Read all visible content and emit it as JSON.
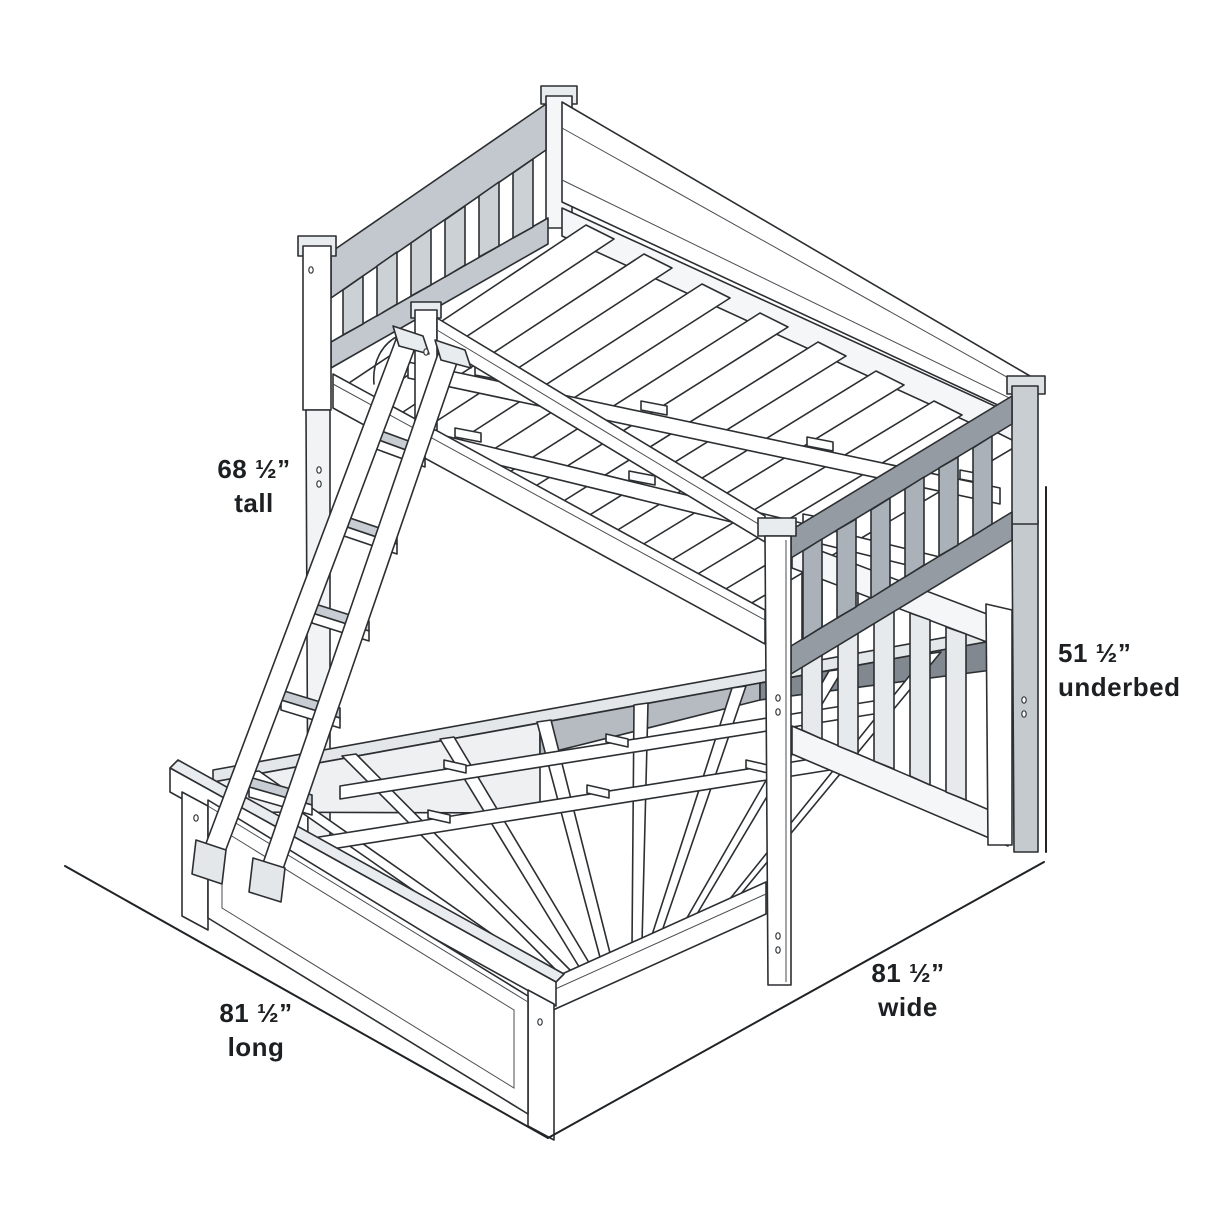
{
  "figure": {
    "type": "product-dimension-diagram",
    "subject": "L-shaped loft bunk bed (twin loft over full bed) line drawing with ladder",
    "dimensions": {
      "tall": {
        "value": "68 ½”",
        "label": "tall"
      },
      "underbed": {
        "value": "51 ½”",
        "label": "underbed"
      },
      "long": {
        "value": "81 ½”",
        "label": "long"
      },
      "wide": {
        "value": "81 ½”",
        "label": "wide"
      }
    },
    "colors": {
      "background": "#ffffff",
      "outline": "#2c2f32",
      "text": "#1d2022",
      "fill_white": "#ffffff",
      "fill_light": "#eef0f2",
      "fill_mid": "#c6cbd0",
      "fill_dark": "#8a9097"
    }
  }
}
